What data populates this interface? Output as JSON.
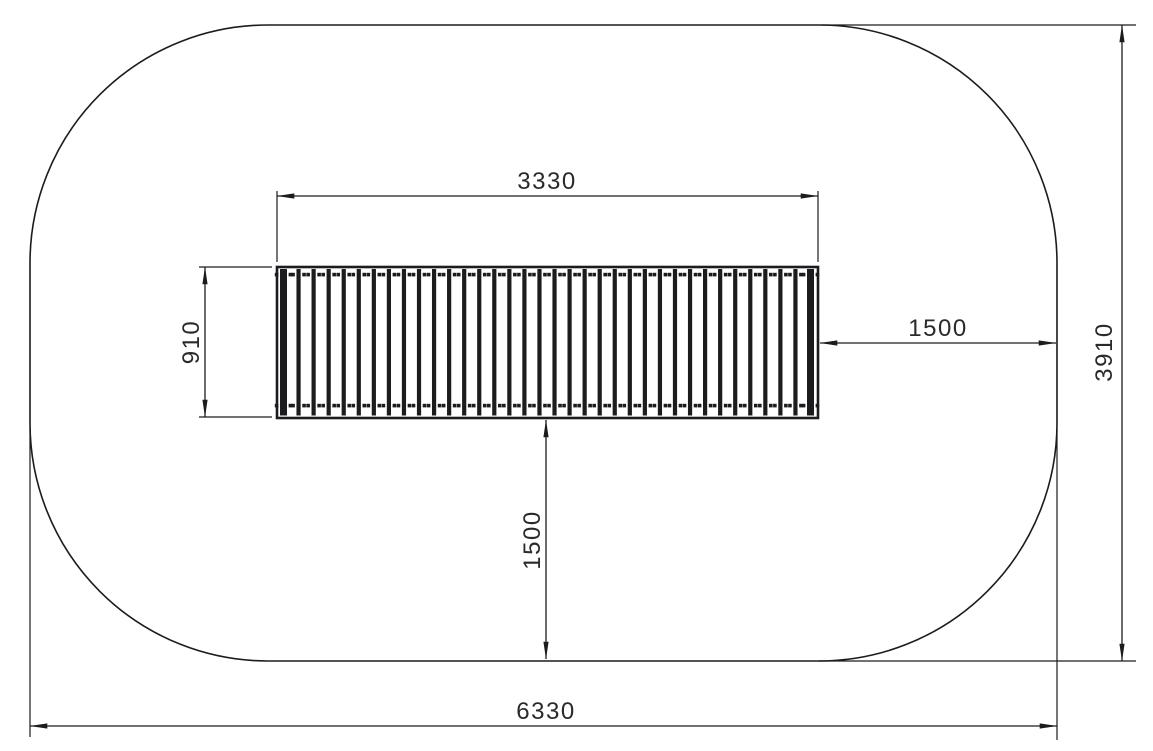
{
  "meta": {
    "title": "Plan view technical drawing",
    "background_color": "#ffffff",
    "line_color": "#1c1c1e",
    "text_color": "#2a2a2c"
  },
  "drawing": {
    "safety_area": {
      "shape": "rounded-rectangle"
    },
    "bridge": {
      "slat_count": 36
    }
  },
  "dimensions": {
    "bridge_length": "3330",
    "bridge_width": "910",
    "clearance_right": "1500",
    "clearance_below": "1500",
    "area_height": "3910",
    "area_width": "6330"
  }
}
